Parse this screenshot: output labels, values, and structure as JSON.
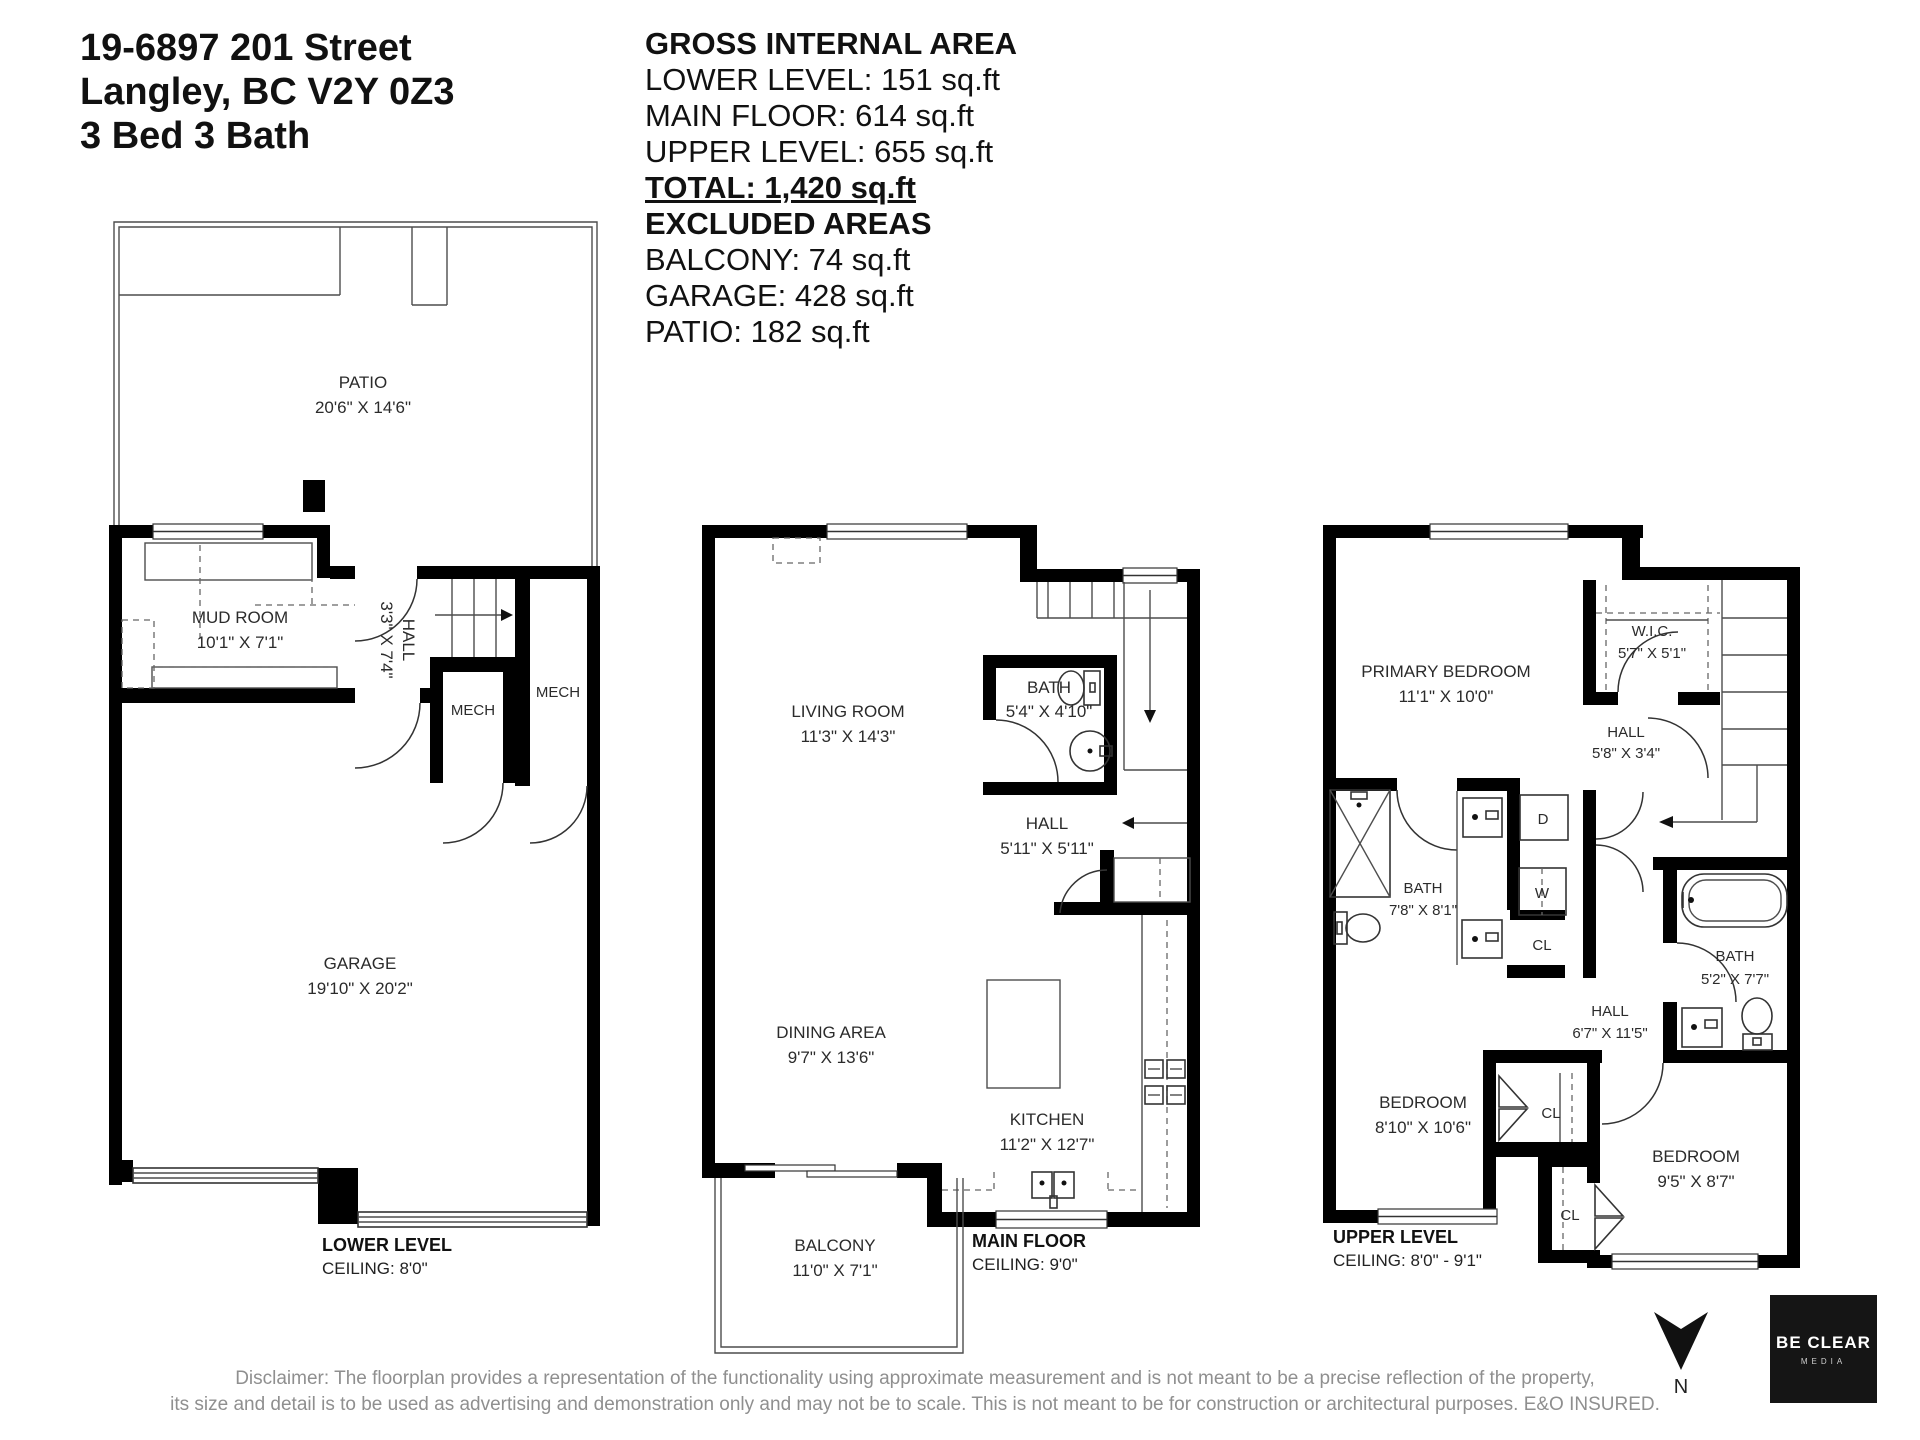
{
  "header": {
    "address_line1": "19-6897 201 Street",
    "address_line2": "Langley, BC V2Y 0Z3",
    "address_line3": "3 Bed 3 Bath"
  },
  "summary": {
    "title": "GROSS INTERNAL AREA",
    "lower": "LOWER LEVEL: 151 sq.ft",
    "main": "MAIN FLOOR: 614 sq.ft",
    "upper": "UPPER LEVEL: 655 sq.ft",
    "total": "TOTAL: 1,420 sq.ft",
    "excluded": "EXCLUDED AREAS",
    "balcony": "BALCONY: 74 sq.ft",
    "garage": "GARAGE: 428 sq.ft",
    "patio": "PATIO: 182 sq.ft"
  },
  "lower_level": {
    "label": "LOWER LEVEL",
    "ceiling": "CEILING: 8'0\"",
    "rooms": {
      "patio": {
        "name": "PATIO",
        "dims": "20'6\" X 14'6\""
      },
      "mud_room": {
        "name": "MUD ROOM",
        "dims": "10'1\" X 7'1\""
      },
      "hall": {
        "name": "HALL",
        "dims": "3'3\" X 7'4\""
      },
      "mech_left": "MECH",
      "mech_right": "MECH",
      "garage": {
        "name": "GARAGE",
        "dims": "19'10\" X 20'2\""
      }
    }
  },
  "main_floor": {
    "label": "MAIN FLOOR",
    "ceiling": "CEILING: 9'0\"",
    "rooms": {
      "living_room": {
        "name": "LIVING ROOM",
        "dims": "11'3\" X 14'3\""
      },
      "bath": {
        "name": "BATH",
        "dims": "5'4\" X 4'10\""
      },
      "hall": {
        "name": "HALL",
        "dims": "5'11\" X 5'11\""
      },
      "dining_area": {
        "name": "DINING AREA",
        "dims": "9'7\" X 13'6\""
      },
      "kitchen": {
        "name": "KITCHEN",
        "dims": "11'2\" X 12'7\""
      },
      "balcony": {
        "name": "BALCONY",
        "dims": "11'0\" X 7'1\""
      }
    }
  },
  "upper_level": {
    "label": "UPPER LEVEL",
    "ceiling": "CEILING: 8'0\" - 9'1\"",
    "rooms": {
      "primary_bedroom": {
        "name": "PRIMARY BEDROOM",
        "dims": "11'1\" X 10'0\""
      },
      "wic": {
        "name": "W.I.C.",
        "dims": "5'7\" X 5'1\""
      },
      "hall_top": {
        "name": "HALL",
        "dims": "5'8\" X 3'4\""
      },
      "bath_ensuite": {
        "name": "BATH",
        "dims": "7'8\" X 8'1\""
      },
      "dryer": "D",
      "washer": "W",
      "closet": "CL",
      "hall_mid": {
        "name": "HALL",
        "dims": "6'7\" X 11'5\""
      },
      "bath2": {
        "name": "BATH",
        "dims": "5'2\" X 7'7\""
      },
      "bedroom_left": {
        "name": "BEDROOM",
        "dims": "8'10\" X 10'6\""
      },
      "bedroom_right": {
        "name": "BEDROOM",
        "dims": "9'5\" X 8'7\""
      },
      "cl_top": "CL",
      "cl_bottom": "CL"
    }
  },
  "footer": {
    "disclaimer_line1": "Disclaimer: The floorplan provides a representation of the functionality using approximate measurement and is not meant to be a precise reflection of the property,",
    "disclaimer_line2": "its size and detail is to be used as advertising and demonstration only and may not be to scale. This is not meant to be for construction or architectural purposes. E&O INSURED."
  },
  "compass": {
    "n": "N"
  },
  "logo": {
    "line1": "BE CLEAR",
    "line2": "MEDIA"
  }
}
